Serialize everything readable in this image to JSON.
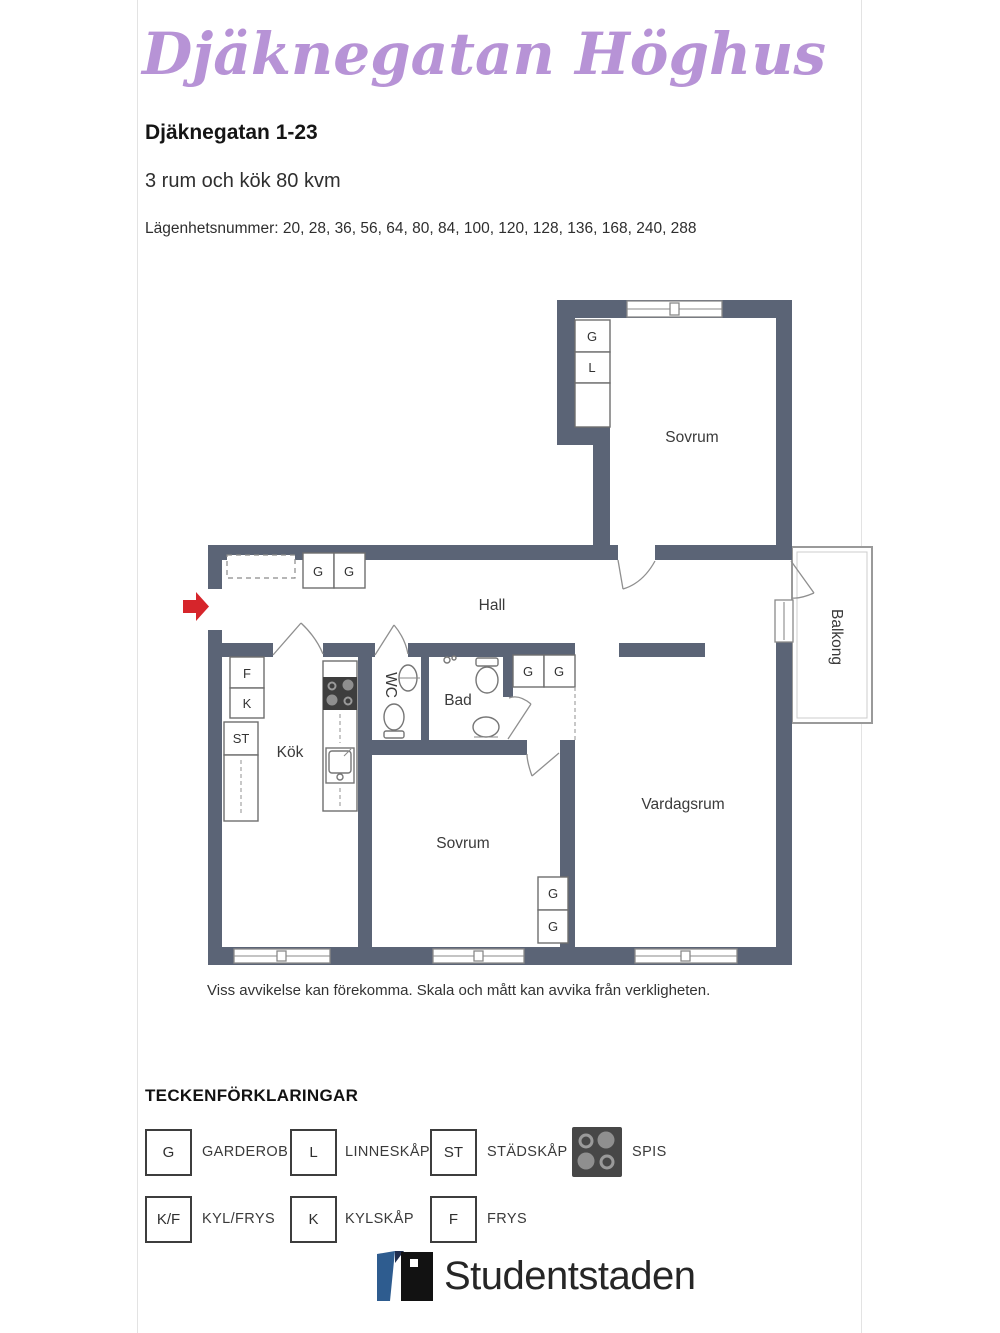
{
  "header": {
    "title": "Djäknegatan Höghus",
    "address": "Djäknegatan 1-23",
    "size": "3 rum och kök 80 kvm",
    "apartments": "Lägenhetsnummer: 20, 28, 36, 56, 64, 80, 84, 100, 120, 128, 136, 168, 240, 288"
  },
  "floorplan": {
    "rooms": {
      "bedroom_top": "Sovrum",
      "hall": "Hall",
      "kitchen": "Kök",
      "wc": "WC",
      "bathroom": "Bad",
      "bedroom_bottom": "Sovrum",
      "living_room": "Vardagsrum",
      "balcony": "Balkong"
    },
    "symbols": {
      "g": "G",
      "l": "L",
      "st": "ST",
      "f": "F",
      "k": "K"
    }
  },
  "disclaimer": "Viss avvikelse kan förekomma. Skala och mått kan avvika från verkligheten.",
  "legend": {
    "heading": "TECKENFÖRKLARINGAR",
    "items": [
      {
        "symbol": "G",
        "label": "GARDEROB"
      },
      {
        "symbol": "L",
        "label": "LINNESKÅP"
      },
      {
        "symbol": "ST",
        "label": "STÄDSKÅP"
      },
      {
        "symbol": "",
        "label": "SPIS",
        "icon": "stove-icon"
      },
      {
        "symbol": "K/F",
        "label": "KYL/FRYS"
      },
      {
        "symbol": "K",
        "label": "KYLSKÅP"
      },
      {
        "symbol": "F",
        "label": "FRYS"
      }
    ]
  },
  "footer": {
    "brand": "Studentstaden"
  },
  "colors": {
    "title": "#b793d6",
    "wall": "#5b6476",
    "arrow": "#d6252b",
    "logo_blue": "#2e5c8f",
    "logo_black": "#121212"
  }
}
